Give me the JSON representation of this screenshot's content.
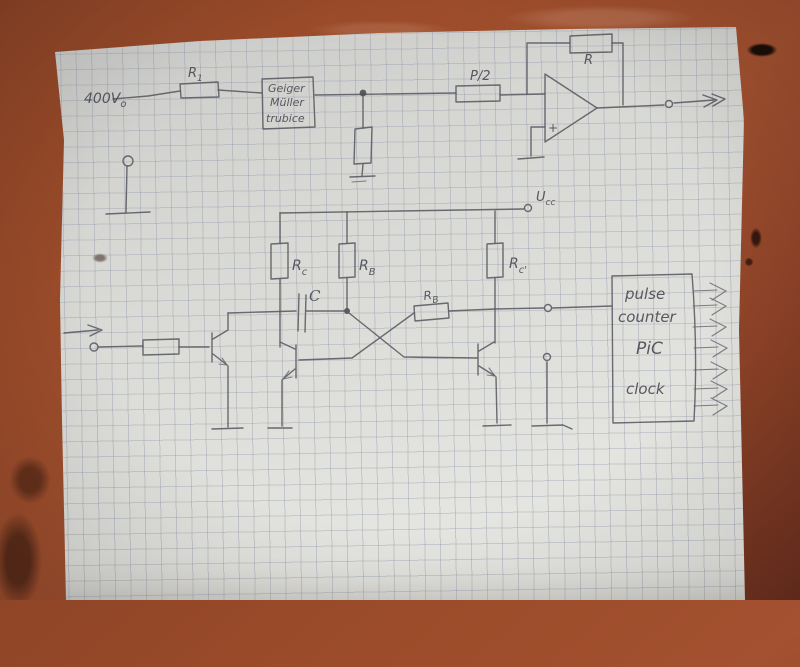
{
  "scene": {
    "description": "Hand-drawn pencil schematic of a Geiger-Mueller counter circuit on squared graph paper, photographed on a brown table"
  },
  "colors": {
    "table": "#9c4c2a",
    "paper": "#dcdcd8",
    "grid_line": "#7a889e",
    "pencil": "#595961"
  },
  "labels": {
    "supply": {
      "base": "400V",
      "sub": "o"
    },
    "r1": {
      "base": "R",
      "sub": "1"
    },
    "geiger_box": {
      "line1": "Geiger",
      "line2": "Müller",
      "line3": "trubice"
    },
    "p_half": "P/2",
    "feedback_r": "R",
    "opamp_plus": "+",
    "ucc": {
      "base": "U",
      "sub": "cc"
    },
    "rc_left": {
      "base": "R",
      "sub": "c"
    },
    "rb_left": {
      "base": "R",
      "sub": "B"
    },
    "rc_right": {
      "base": "R",
      "sub": "c'"
    },
    "cap": "C",
    "rb_cross": {
      "base": "R",
      "sub": "B"
    },
    "pic_box": {
      "line1": "pulse",
      "line2": "counter",
      "line3": "PiC",
      "line4": "clock"
    }
  }
}
